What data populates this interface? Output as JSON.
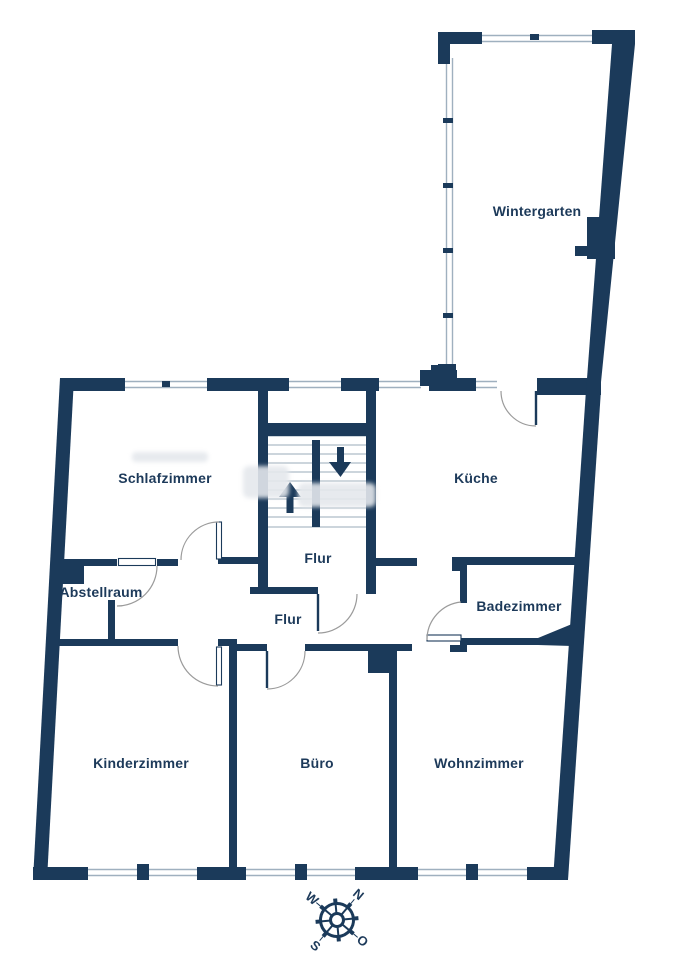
{
  "floorplan": {
    "rooms": [
      {
        "id": "wintergarten",
        "label": "Wintergarten"
      },
      {
        "id": "schlafzimmer",
        "label": "Schlafzimmer"
      },
      {
        "id": "kueche",
        "label": "Küche"
      },
      {
        "id": "flur-oben",
        "label": "Flur"
      },
      {
        "id": "abstellraum",
        "label": "Abstellraum"
      },
      {
        "id": "flur-mitte",
        "label": "Flur"
      },
      {
        "id": "badezimmer",
        "label": "Badezimmer"
      },
      {
        "id": "kinderzimmer",
        "label": "Kinderzimmer"
      },
      {
        "id": "buero",
        "label": "Büro"
      },
      {
        "id": "wohnzimmer",
        "label": "Wohnzimmer"
      }
    ],
    "compass": {
      "north": "N",
      "east": "O",
      "south": "S",
      "west": "W"
    },
    "colors": {
      "wall": "#1b3a5a",
      "label": "#1d3a5a",
      "window_line": "#9fb0bf",
      "stair_line": "#9aabb9",
      "door_arc": "#9b9b9b",
      "background": "#ffffff"
    }
  }
}
